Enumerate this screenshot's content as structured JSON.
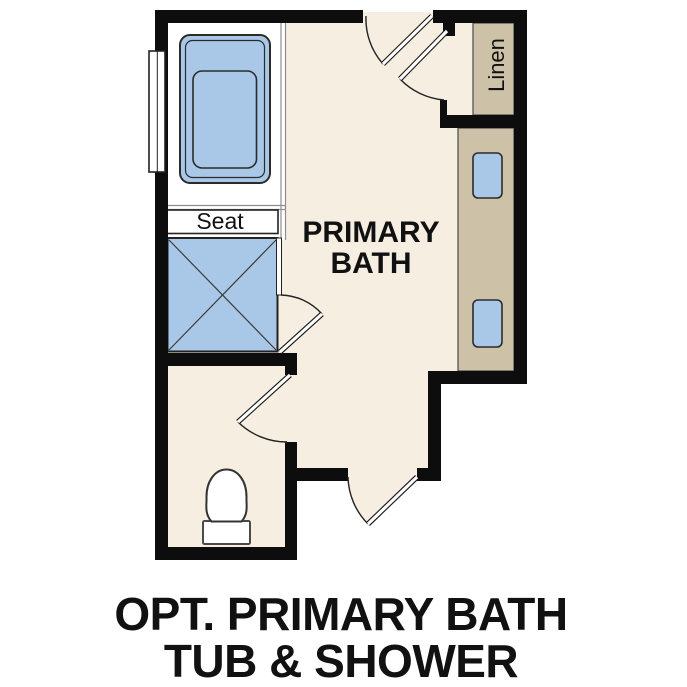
{
  "caption": {
    "line1": "OPT. PRIMARY BATH",
    "line2": "TUB & SHOWER"
  },
  "room": {
    "label_line1": "PRIMARY",
    "label_line2": "BATH"
  },
  "labels": {
    "seat": "Seat",
    "linen": "Linen"
  },
  "fixtures": [
    "bathtub",
    "window",
    "shower",
    "shower-seat-bench",
    "shower-glass-door",
    "toilet",
    "water-closet-door",
    "entry-swing-door",
    "top-swing-door",
    "linen-closet-door",
    "linen-shelf",
    "vanity-counter",
    "vanity-sink",
    "vanity-sink"
  ],
  "colors": {
    "wall": "#0d0d0d",
    "floor": "#f5eee1",
    "fixture_blue": "#a9c8e8",
    "cabinet_tan": "#cdc2a8",
    "alcove_white": "#ffffff",
    "divider_gray": "#8f8f8f",
    "text": "#111111"
  }
}
